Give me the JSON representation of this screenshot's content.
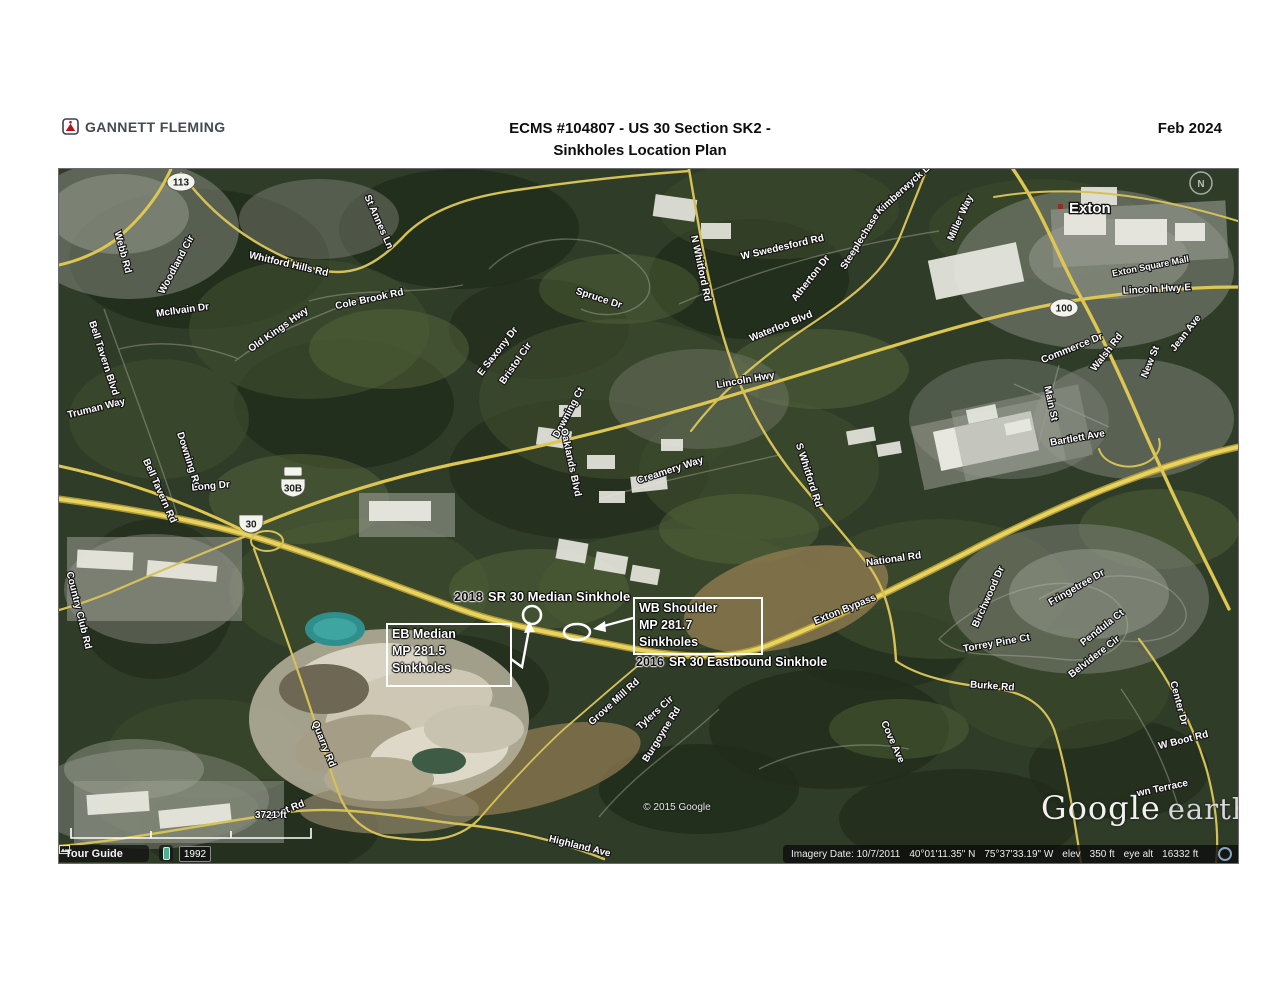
{
  "header": {
    "logo_text": "GANNETT FLEMING",
    "title_line1": "ECMS #104807 - US 30 Section SK2 -",
    "title_line2": "Sinkholes Location Plan",
    "date": "Feb 2024"
  },
  "colors": {
    "road_yellow": "#d9c24d",
    "map_green": "#2f3c28",
    "logo_red": "#b5121b",
    "annotation_white": "#ffffff"
  },
  "map": {
    "city_label": "Exton",
    "compass": "N",
    "copyright": "© 2015 Google",
    "watermark_word1": "Google",
    "watermark_word2": "earth",
    "scale_label": "3721 ft",
    "road_labels": [
      {
        "t": "Webb Rd",
        "x": 61,
        "y": 84,
        "r": 75
      },
      {
        "t": "Woodland Cir",
        "x": 120,
        "y": 97,
        "r": -62
      },
      {
        "t": "Whitford Hills Rd",
        "x": 229,
        "y": 98,
        "r": 13
      },
      {
        "t": "McIlvain Dr",
        "x": 124,
        "y": 144,
        "r": -8
      },
      {
        "t": "Old Kings Hwy",
        "x": 221,
        "y": 163,
        "r": -35
      },
      {
        "t": "Cole Brook Rd",
        "x": 311,
        "y": 133,
        "r": -12
      },
      {
        "t": "St Annes Ln",
        "x": 317,
        "y": 54,
        "r": 66
      },
      {
        "t": "Spruce Dr",
        "x": 539,
        "y": 132,
        "r": 18
      },
      {
        "t": "E Saxony Dr",
        "x": 441,
        "y": 184,
        "r": -52
      },
      {
        "t": "Bristol Cir",
        "x": 459,
        "y": 196,
        "r": -55
      },
      {
        "t": "Downing Ct",
        "x": 512,
        "y": 245,
        "r": -62
      },
      {
        "t": "Downing Rd",
        "x": 127,
        "y": 292,
        "r": 72
      },
      {
        "t": "Long Dr",
        "x": 152,
        "y": 320,
        "r": -5
      },
      {
        "t": "Oaklands Blvd",
        "x": 509,
        "y": 294,
        "r": 78
      },
      {
        "t": "Creamery Way",
        "x": 612,
        "y": 304,
        "r": -18
      },
      {
        "t": "Lincoln Hwy",
        "x": 687,
        "y": 214,
        "r": -10
      },
      {
        "t": "Waterloo Blvd",
        "x": 723,
        "y": 160,
        "r": -22
      },
      {
        "t": "W Swedesford Rd",
        "x": 724,
        "y": 81,
        "r": -13
      },
      {
        "t": "Atherton Dr",
        "x": 754,
        "y": 111,
        "r": -52
      },
      {
        "t": "Steeplechase Dr",
        "x": 807,
        "y": 68,
        "r": -58
      },
      {
        "t": "Kimberwyck Ln",
        "x": 848,
        "y": 21,
        "r": -42
      },
      {
        "t": "Miller Way",
        "x": 904,
        "y": 50,
        "r": -66
      },
      {
        "t": "N Whitford Rd",
        "x": 639,
        "y": 100,
        "r": 78
      },
      {
        "t": "S Whitford Rd",
        "x": 747,
        "y": 307,
        "r": 72
      },
      {
        "t": "National Rd",
        "x": 835,
        "y": 393,
        "r": -8
      },
      {
        "t": "Exton Bypass",
        "x": 787,
        "y": 443,
        "r": -22
      },
      {
        "t": "Bartlett Ave",
        "x": 1019,
        "y": 272,
        "r": -10
      },
      {
        "t": "Main St",
        "x": 989,
        "y": 235,
        "r": 78
      },
      {
        "t": "Birchwood Dr",
        "x": 932,
        "y": 429,
        "r": -66
      },
      {
        "t": "Fringetree Dr",
        "x": 1019,
        "y": 421,
        "r": -30
      },
      {
        "t": "Pendula Ct",
        "x": 1045,
        "y": 461,
        "r": -38
      },
      {
        "t": "Belvidere Cir",
        "x": 1037,
        "y": 490,
        "r": -38
      },
      {
        "t": "Torrey Pine Ct",
        "x": 938,
        "y": 477,
        "r": -10
      },
      {
        "t": "Burke Rd",
        "x": 933,
        "y": 520,
        "r": 4
      },
      {
        "t": "Cove Ave",
        "x": 831,
        "y": 574,
        "r": 66
      },
      {
        "t": "Center Dr",
        "x": 1117,
        "y": 535,
        "r": 75
      },
      {
        "t": "W Boot Rd",
        "x": 1125,
        "y": 574,
        "r": -14
      },
      {
        "t": "wn Terrace",
        "x": 1104,
        "y": 622,
        "r": -12
      },
      {
        "t": "Grove Mill Rd",
        "x": 557,
        "y": 535,
        "r": -42
      },
      {
        "t": "Tylers Cir",
        "x": 598,
        "y": 546,
        "r": -42
      },
      {
        "t": "Burgoyne Rd",
        "x": 605,
        "y": 567,
        "r": -58
      },
      {
        "t": "Quarry Rd",
        "x": 262,
        "y": 576,
        "r": 68
      },
      {
        "t": "Highland Ave",
        "x": 520,
        "y": 680,
        "r": 14
      },
      {
        "t": "Boot Rd",
        "x": 228,
        "y": 644,
        "r": -22
      },
      {
        "t": "Country Club Rd",
        "x": 17,
        "y": 442,
        "r": 76
      },
      {
        "t": "Bell Tavern Blvd",
        "x": 42,
        "y": 190,
        "r": 72
      },
      {
        "t": "Bell Tavern Rd",
        "x": 98,
        "y": 323,
        "r": 66
      },
      {
        "t": "Truman Way",
        "x": 38,
        "y": 242,
        "r": -14
      },
      {
        "t": "Lincoln Hwy E",
        "x": 1098,
        "y": 123,
        "r": -3
      },
      {
        "t": "Commerce Dr",
        "x": 1014,
        "y": 182,
        "r": -22
      },
      {
        "t": "Walsh Rd",
        "x": 1050,
        "y": 185,
        "r": -52
      },
      {
        "t": "New St",
        "x": 1094,
        "y": 194,
        "r": -68
      },
      {
        "t": "Jean Ave",
        "x": 1129,
        "y": 166,
        "r": -52
      },
      {
        "t": "Exton Square Mall",
        "x": 1092,
        "y": 100,
        "r": -11,
        "s": 9
      }
    ],
    "shields": [
      {
        "t": "113",
        "x": 122,
        "y": 13,
        "shape": "oval"
      },
      {
        "t": "30B",
        "x": 234,
        "y": 319,
        "shape": "us",
        "banner": true
      },
      {
        "t": "30",
        "x": 192,
        "y": 355,
        "shape": "us"
      },
      {
        "t": "100",
        "x": 1005,
        "y": 139,
        "shape": "oval"
      }
    ],
    "annotations": {
      "median_label": {
        "year": "2018",
        "text": "SR 30 Median Sinkhole"
      },
      "eastbound_label": {
        "year": "2016",
        "text": "SR 30 Eastbound Sinkhole"
      },
      "eb_box": {
        "line1": "EB Median",
        "line2": "MP 281.5",
        "line3": "Sinkholes"
      },
      "wb_box": {
        "line1": "WB Shoulder",
        "line2": "MP 281.7",
        "line3": "Sinkholes"
      }
    },
    "status_left": {
      "tour_guide": "Tour Guide",
      "year": "1992"
    },
    "status_right": {
      "imagery": "Imagery Date: 10/7/2011",
      "lat": "40°01'11.35\" N",
      "lon": "75°37'33.19\" W",
      "elev_label": "elev",
      "elev_value": "350 ft",
      "eye_label": "eye alt",
      "eye_value": "16332 ft"
    }
  }
}
